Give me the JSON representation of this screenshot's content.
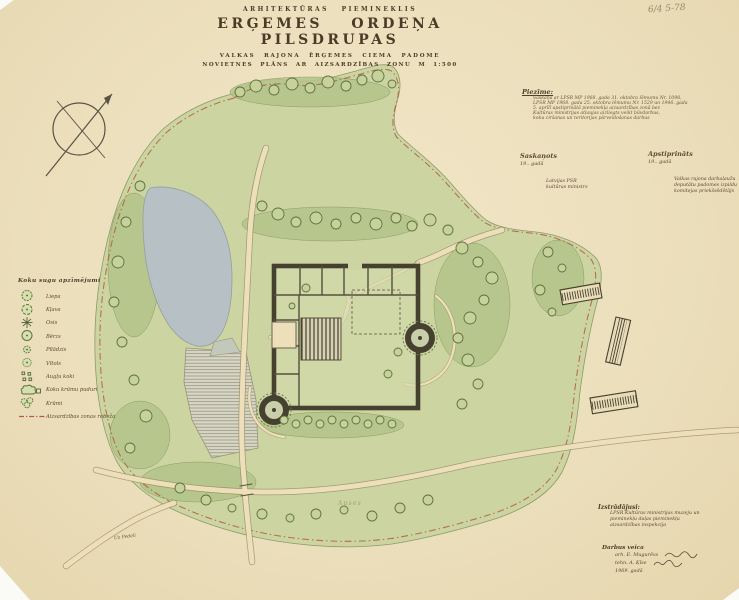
{
  "palette": {
    "paper": "#ecdfbc",
    "zone_green": "#ccd5a1",
    "water": "#b6c0c5",
    "wall_ink": "#45402f",
    "boundary_red": "#b25a45",
    "text_ink": "#5c4a31"
  },
  "catalog_number": "6/4 5-78",
  "header": {
    "supertitle": "ARHITEKTŪRAS PIEMINEKLIS",
    "title": "ERĢEMES ORDEŅA PILSDRUPAS",
    "subtitle1": "VALKAS RAJONA ĒRĢEMES CIEMA PADOME",
    "subtitle2": "NOVIETNES PLĀNS AR AIZSARDZĪBAS ZONU M 1:500"
  },
  "note": {
    "heading": "Piezīme:",
    "lines": [
      "Saskaņā ar LPSR MP 1968. gada 31. oktobra lēmumu Nr. 1098,",
      "LPSR MP 1968. gada 25. oktobra lēmumu Nr. 1529 un 1946. gada",
      "5. aprīlī apstiprinātā pieminekļa aizsardzības zonā bez",
      "Kultūras ministrijas atļaujas aizliegts veikt būvdarbus,",
      "koku ciršanas un teritorijas pārveidošanas darbus"
    ]
  },
  "approvals": {
    "left": {
      "heading": "Saskaņots",
      "year": "19..  gadā",
      "sig1": "Latvijas PSR",
      "sig2": "kultūras ministrs"
    },
    "right": {
      "heading": "Apstiprināts",
      "year": "19..  gadā",
      "sig1": "Valkas rajona darbaļaužu",
      "sig2": "deputātu padomes izpildu",
      "sig3": "komitejas priekšsēdētājs"
    }
  },
  "legend": {
    "heading": "Koku sugu apzīmējumi",
    "items": [
      {
        "label": "Liepa",
        "symbol": "linden-tree-symbol"
      },
      {
        "label": "Kļava",
        "symbol": "maple-tree-symbol"
      },
      {
        "label": "Osis",
        "symbol": "ash-tree-symbol"
      },
      {
        "label": "Bērzs",
        "symbol": "birch-tree-symbol"
      },
      {
        "label": "Pīlādzis",
        "symbol": "rowan-tree-symbol"
      },
      {
        "label": "Vītols",
        "symbol": "willow-tree-symbol"
      },
      {
        "label": "Augļu koki",
        "symbol": "fruit-trees-symbol"
      },
      {
        "label": "Koku krūmu puduri",
        "symbol": "tree-shrub-group-symbol"
      },
      {
        "label": "Krūmi",
        "symbol": "shrub-symbol"
      },
      {
        "label": "Aizsardzības zonas robeža",
        "symbol": "protection-zone-boundary-line"
      }
    ]
  },
  "map_labels": {
    "grove": "Apses",
    "road": "Uz Pedeli"
  },
  "credits": {
    "developer_heading": "Izstrādājusi:",
    "developer_lines": [
      "LPSR Kultūras ministrijas muzeju un",
      "pieminekļu daļas pieminekļu",
      "aizsardzības inspekcija"
    ],
    "work_heading": "Darbus veica",
    "workers": [
      "arh. E. Mugurēvs",
      "tehn. A. Ķīse"
    ],
    "year": "1969. gadā"
  }
}
